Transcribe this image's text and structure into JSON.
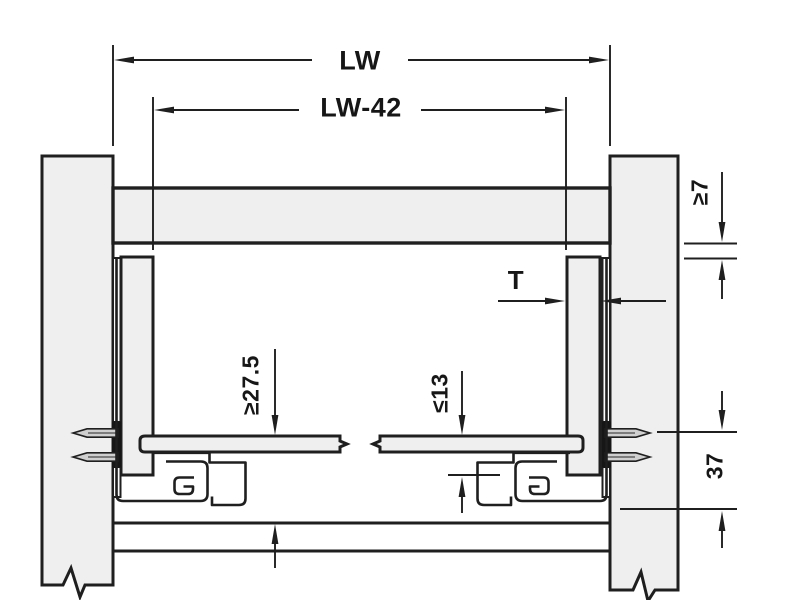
{
  "drawing": {
    "labels": {
      "lw": "LW",
      "lw_minus_42": "LW-42",
      "thickness": "T",
      "min_7": "≥7",
      "min_27_5": "≥27.5",
      "max_13": "≤13",
      "dim_37": "37"
    },
    "colors": {
      "line": "#1f1f1f",
      "panel_fill": "#efefef",
      "rail_fill": "#ffffff",
      "background": "#ffffff"
    }
  }
}
